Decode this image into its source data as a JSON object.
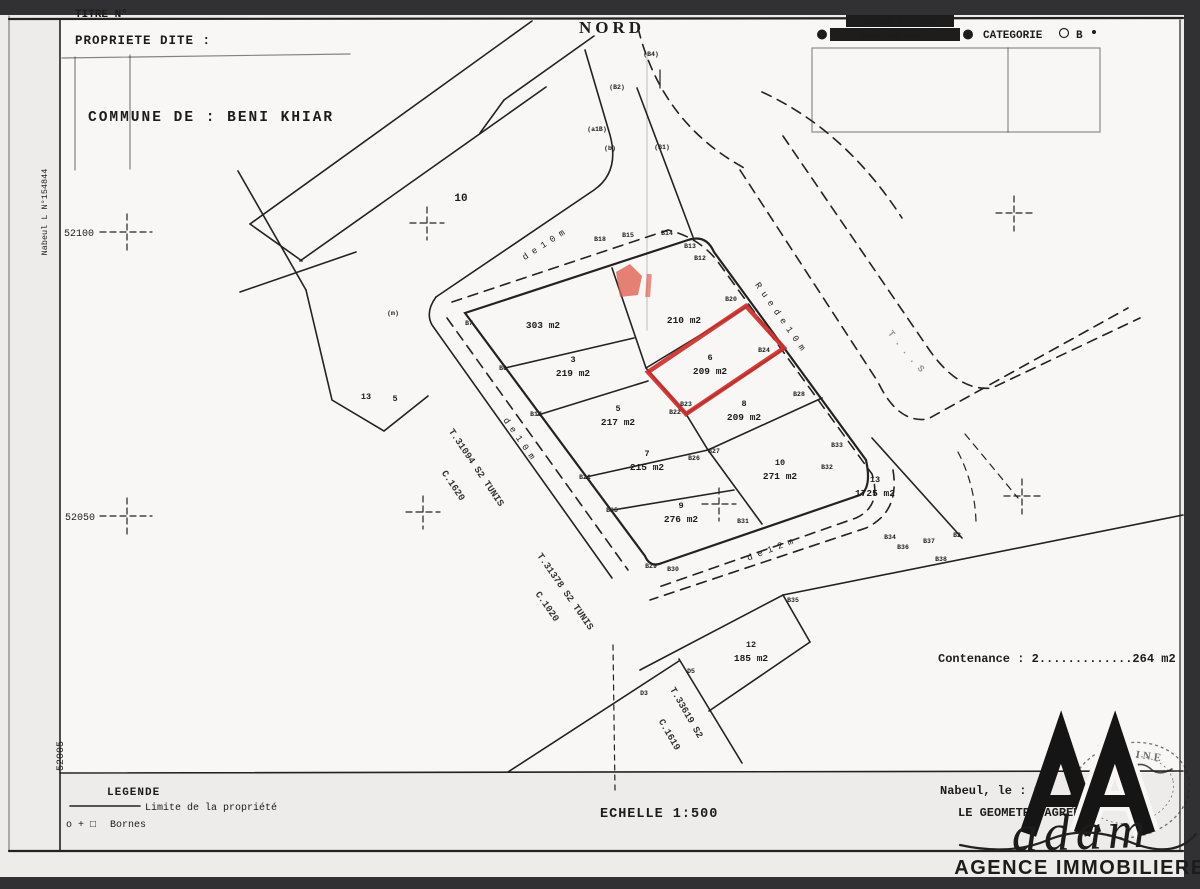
{
  "colors": {
    "paper": "#edecea",
    "map_paper": "#f8f7f5",
    "ink": "#1c1c1c",
    "bar": "#313133",
    "red": "#c9302a",
    "red_soft": "#dd5a48"
  },
  "header": {
    "titre": "TITRE N°",
    "propriete": "PROPRIETE DITE :",
    "nord": "NORD",
    "bureau_line1": "BUREAU D'ETUDES",
    "bureau_line2": "GEOMETRE AGREE",
    "categorie": "CATEGORIE",
    "categorie_value": "B"
  },
  "commune": "COMMUNE DE :  BENI KHIAR",
  "margin_left": {
    "reference": "Nabeul L N°154844",
    "y_52100": "52100",
    "y_52050": "52050",
    "y_52005": "52005"
  },
  "map": {
    "street_labels": [
      {
        "t": "d e   1 0   m",
        "x": 545,
        "y": 247,
        "r": -33,
        "s": 9
      },
      {
        "t": "R u e   d e   1 0   m",
        "x": 778,
        "y": 318,
        "r": 55,
        "s": 9
      },
      {
        "t": "d e   1 0   m",
        "x": 517,
        "y": 440,
        "r": 55,
        "s": 9
      },
      {
        "t": "d e   1 2   m",
        "x": 771,
        "y": 552,
        "r": -21,
        "s": 9
      }
    ],
    "ref_labels": [
      {
        "t": "T.31094 S2 TUNIS",
        "x": 474,
        "y": 469,
        "r": 56
      },
      {
        "t": "C.1620",
        "x": 451,
        "y": 487,
        "r": 56
      },
      {
        "t": "T.31378 S2 TUNIS",
        "x": 563,
        "y": 593,
        "r": 55
      },
      {
        "t": "C.1020",
        "x": 545,
        "y": 608,
        "r": 55
      },
      {
        "t": "T.33619 S2",
        "x": 684,
        "y": 714,
        "r": 60
      },
      {
        "t": "C.1619",
        "x": 667,
        "y": 736,
        "r": 60
      },
      {
        "t": "T . . .   S",
        "x": 904,
        "y": 353,
        "r": 50,
        "f": true
      }
    ],
    "plots": [
      {
        "num": "",
        "area": "303 m2",
        "x": 543,
        "y": 328
      },
      {
        "num": "",
        "area": "210 m2",
        "x": 684,
        "y": 323
      },
      {
        "num": "3",
        "area": "219 m2",
        "x": 573,
        "y": 362
      },
      {
        "num": "6",
        "area": "209 m2",
        "x": 710,
        "y": 360
      },
      {
        "num": "5",
        "area": "217 m2",
        "x": 618,
        "y": 411
      },
      {
        "num": "8",
        "area": "209 m2",
        "x": 744,
        "y": 406
      },
      {
        "num": "7",
        "area": "215 m2",
        "x": 647,
        "y": 456
      },
      {
        "num": "9",
        "area": "276 m2",
        "x": 681,
        "y": 508
      },
      {
        "num": "10",
        "area": "271 m2",
        "x": 780,
        "y": 465
      },
      {
        "num": "13",
        "area": "1725 m2",
        "x": 875,
        "y": 482
      },
      {
        "num": "12",
        "area": "185 m2",
        "x": 751,
        "y": 647
      },
      {
        "num": "10",
        "area": "",
        "x": 461,
        "y": 201,
        "big": true
      },
      {
        "num": "13",
        "area": "",
        "x": 366,
        "y": 399
      },
      {
        "num": "5",
        "area": "",
        "x": 395,
        "y": 401
      }
    ],
    "points": [
      {
        "t": "B18",
        "x": 600,
        "y": 241
      },
      {
        "t": "B15",
        "x": 628,
        "y": 237
      },
      {
        "t": "B14",
        "x": 667,
        "y": 235
      },
      {
        "t": "B13",
        "x": 690,
        "y": 248
      },
      {
        "t": "B12",
        "x": 700,
        "y": 260
      },
      {
        "t": "B20",
        "x": 731,
        "y": 301
      },
      {
        "t": "B24",
        "x": 764,
        "y": 352
      },
      {
        "t": "B28",
        "x": 799,
        "y": 396
      },
      {
        "t": "B33",
        "x": 837,
        "y": 447
      },
      {
        "t": "B32",
        "x": 827,
        "y": 469
      },
      {
        "t": "B31",
        "x": 743,
        "y": 523
      },
      {
        "t": "B30",
        "x": 673,
        "y": 571
      },
      {
        "t": "B29",
        "x": 651,
        "y": 568
      },
      {
        "t": "B7",
        "x": 469,
        "y": 325
      },
      {
        "t": "B6",
        "x": 503,
        "y": 370
      },
      {
        "t": "B17",
        "x": 536,
        "y": 416
      },
      {
        "t": "B21",
        "x": 585,
        "y": 479
      },
      {
        "t": "B25",
        "x": 612,
        "y": 512
      },
      {
        "t": "B23",
        "x": 686,
        "y": 406
      },
      {
        "t": "B22",
        "x": 675,
        "y": 414
      },
      {
        "t": "B26",
        "x": 694,
        "y": 460
      },
      {
        "t": "B27",
        "x": 714,
        "y": 453
      },
      {
        "t": "B34",
        "x": 890,
        "y": 539
      },
      {
        "t": "B36",
        "x": 903,
        "y": 549
      },
      {
        "t": "B37",
        "x": 929,
        "y": 543
      },
      {
        "t": "B38",
        "x": 941,
        "y": 561
      },
      {
        "t": "B2",
        "x": 957,
        "y": 537
      },
      {
        "t": "B35",
        "x": 793,
        "y": 602
      },
      {
        "t": "D5",
        "x": 691,
        "y": 673
      },
      {
        "t": "D3",
        "x": 644,
        "y": 695
      },
      {
        "t": "(B4)",
        "x": 651,
        "y": 56
      },
      {
        "t": "(B2)",
        "x": 617,
        "y": 89
      },
      {
        "t": "(a1B)",
        "x": 597,
        "y": 131
      },
      {
        "t": "(b)",
        "x": 610,
        "y": 150
      },
      {
        "t": "(B1)",
        "x": 662,
        "y": 149
      },
      {
        "t": "(m)",
        "x": 393,
        "y": 315
      }
    ]
  },
  "footer": {
    "contenance": "Contenance :  2.............264 m2",
    "legende_title": "LEGENDE",
    "legende_limite": "Limite de la propriété",
    "bornes_symbols": "o + □",
    "bornes_label": "Bornes",
    "echelle": "ECHELLE 1:500",
    "nabeul": "Nabeul, le : 20",
    "geometre": "LE GEOMETRE AGREE"
  },
  "logo": {
    "script": "adam",
    "subtitle": "AGENCE IMMOBILIERE"
  },
  "stamp": {
    "text": "YASSINE"
  }
}
